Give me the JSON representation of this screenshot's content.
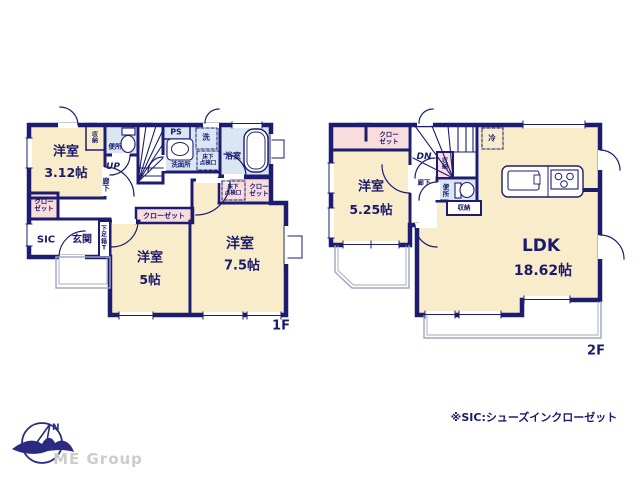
{
  "colors": {
    "wall": "#1d1d70",
    "room_cream": "#f8ecca",
    "wet_blue": "#dbe6f4",
    "closet_pink": "#f9dcdc",
    "balcony_gray": "#a0a6c0",
    "brand_gray": "#cccccc"
  },
  "compass": {
    "north": "N"
  },
  "brand": "ME Group",
  "note": "※SIC:シューズインクローゼット",
  "floor1": {
    "label": "1F",
    "room_312": {
      "name": "洋室",
      "size": "3.12帖"
    },
    "storage_nook": "収納",
    "toilet": "便所",
    "stairs": "UP",
    "hallway": "廊下",
    "ps": "PS",
    "washroom": "洗面所",
    "laundry": "洗",
    "hatch_washroom": "床下\n点検口",
    "bath": "浴室",
    "hatch_closet": "床下\n点検口",
    "closet_right": "クロー\nゼット",
    "closet_center": "クローゼット",
    "closet_left": "クロー\nゼット",
    "sic": "SIC",
    "entrance": "玄関",
    "shoe_cabinet": "下足箱T",
    "room_5": {
      "name": "洋室",
      "size": "5帖"
    },
    "room_75": {
      "name": "洋室",
      "size": "7.5帖"
    }
  },
  "floor2": {
    "label": "2F",
    "closet": "クロー\nゼット",
    "room_525": {
      "name": "洋室",
      "size": "5.25帖"
    },
    "stairs": "DN",
    "storage_stairs": "収納",
    "hallway": "廊下",
    "toilet": "便所",
    "storage_hall": "収納",
    "fridge": "冷",
    "ldk": {
      "name": "LDK",
      "size": "18.62帖"
    }
  }
}
